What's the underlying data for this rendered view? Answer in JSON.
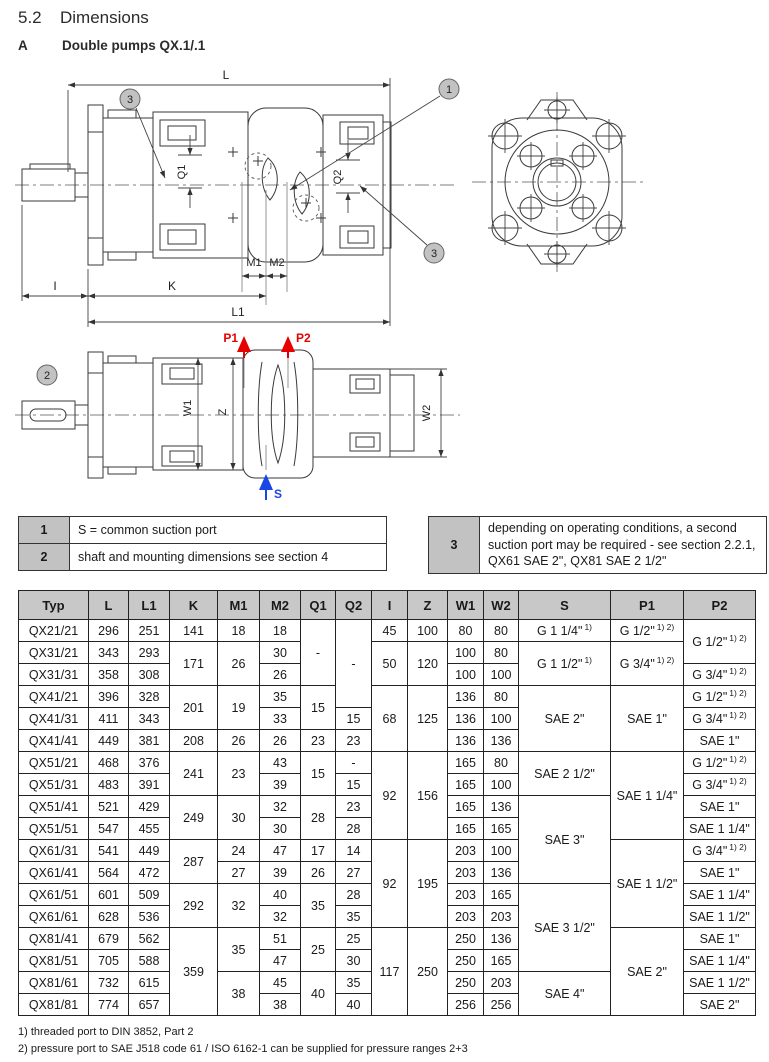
{
  "page": {
    "section": "5.2",
    "title": "Dimensions",
    "item_letter": "A",
    "subtitle": "Double pumps QX.1/.1"
  },
  "drawing": {
    "dim_labels": {
      "L": "L",
      "L1": "L1",
      "K": "K",
      "I": "I",
      "M1": "M1",
      "M2": "M2",
      "Q1": "Q1",
      "Q2": "Q2",
      "W1": "W1",
      "W2": "W2",
      "Z": "Z"
    },
    "ports": {
      "P1": "P1",
      "P2": "P2",
      "S": "S"
    },
    "callouts": {
      "c1": "1",
      "c2": "2",
      "c3": "3"
    },
    "colors": {
      "pressure_port": "#e60000",
      "suction_port": "#1a46e6",
      "line": "#3a3a3a",
      "callout_fill": "#c2c2c2",
      "table_header": "#c8c8c8"
    }
  },
  "legend": {
    "notes": [
      {
        "num": "1",
        "text": "S = common suction port"
      },
      {
        "num": "2",
        "text": "shaft and mounting dimensions see section 4"
      },
      {
        "num": "3",
        "text": "depending on operating conditions, a second suction port may be required - see section 2.2.1, QX61 SAE 2\", QX81 SAE 2 1/2\""
      }
    ]
  },
  "table": {
    "header": [
      "Typ",
      "L",
      "L1",
      "K",
      "M1",
      "M2",
      "Q1",
      "Q2",
      "I",
      "Z",
      "W1",
      "W2",
      "S",
      "P1",
      "P2"
    ],
    "rows": [
      [
        {
          "t": "QX21/21"
        },
        {
          "t": "296"
        },
        {
          "t": "251"
        },
        {
          "t": "141"
        },
        {
          "t": "18"
        },
        {
          "t": "18"
        },
        {
          "t": "-",
          "rs": 3
        },
        {
          "t": "-",
          "rs": 4
        },
        {
          "t": "45"
        },
        {
          "t": "100"
        },
        {
          "t": "80"
        },
        {
          "t": "80"
        },
        {
          "t": "G 1 1/4\"",
          "sup": "1)"
        },
        {
          "t": "G 1/2\"",
          "sup": "1) 2)"
        },
        {
          "t": "G 1/2\"",
          "sup": "1) 2)",
          "rs": 2
        }
      ],
      [
        {
          "t": "QX31/21"
        },
        {
          "t": "343"
        },
        {
          "t": "293"
        },
        {
          "t": "171",
          "rs": 2
        },
        {
          "t": "26",
          "rs": 2
        },
        {
          "t": "30"
        },
        {
          "t": "50",
          "rs": 2
        },
        {
          "t": "120",
          "rs": 2
        },
        {
          "t": "100"
        },
        {
          "t": "80"
        },
        {
          "t": "G 1 1/2\"",
          "sup": "1)",
          "rs": 2
        },
        {
          "t": "G 3/4\"",
          "sup": "1) 2)",
          "rs": 2
        }
      ],
      [
        {
          "t": "QX31/31"
        },
        {
          "t": "358"
        },
        {
          "t": "308"
        },
        {
          "t": "26"
        },
        {
          "t": "100"
        },
        {
          "t": "100"
        },
        {
          "t": "G 3/4\"",
          "sup": "1) 2)"
        }
      ],
      [
        {
          "t": "QX41/21"
        },
        {
          "t": "396"
        },
        {
          "t": "328"
        },
        {
          "t": "201",
          "rs": 2
        },
        {
          "t": "19",
          "rs": 2
        },
        {
          "t": "35"
        },
        {
          "t": "15",
          "rs": 2
        },
        {
          "t": "68",
          "rs": 3
        },
        {
          "t": "125",
          "rs": 3
        },
        {
          "t": "136"
        },
        {
          "t": "80"
        },
        {
          "t": "SAE 2\"",
          "rs": 3
        },
        {
          "t": "SAE 1\"",
          "rs": 3
        },
        {
          "t": "G 1/2\"",
          "sup": "1) 2)"
        }
      ],
      [
        {
          "t": "QX41/31"
        },
        {
          "t": "411"
        },
        {
          "t": "343"
        },
        {
          "t": "33"
        },
        {
          "t": "15"
        },
        {
          "t": "136"
        },
        {
          "t": "100"
        },
        {
          "t": "G 3/4\"",
          "sup": "1) 2)"
        }
      ],
      [
        {
          "t": "QX41/41"
        },
        {
          "t": "449"
        },
        {
          "t": "381"
        },
        {
          "t": "208"
        },
        {
          "t": "26"
        },
        {
          "t": "26"
        },
        {
          "t": "23"
        },
        {
          "t": "23"
        },
        {
          "t": "136"
        },
        {
          "t": "136"
        },
        {
          "t": "SAE 1\""
        }
      ],
      [
        {
          "t": "QX51/21"
        },
        {
          "t": "468"
        },
        {
          "t": "376"
        },
        {
          "t": "241",
          "rs": 2
        },
        {
          "t": "23",
          "rs": 2
        },
        {
          "t": "43"
        },
        {
          "t": "15",
          "rs": 2
        },
        {
          "t": "-"
        },
        {
          "t": "92",
          "rs": 4
        },
        {
          "t": "156",
          "rs": 4
        },
        {
          "t": "165"
        },
        {
          "t": "80"
        },
        {
          "t": "SAE 2 1/2\"",
          "rs": 2
        },
        {
          "t": "SAE 1 1/4\"",
          "rs": 4
        },
        {
          "t": "G 1/2\"",
          "sup": "1) 2)"
        }
      ],
      [
        {
          "t": "QX51/31"
        },
        {
          "t": "483"
        },
        {
          "t": "391"
        },
        {
          "t": "39"
        },
        {
          "t": "15"
        },
        {
          "t": "165"
        },
        {
          "t": "100"
        },
        {
          "t": "G 3/4\"",
          "sup": "1) 2)"
        }
      ],
      [
        {
          "t": "QX51/41"
        },
        {
          "t": "521"
        },
        {
          "t": "429"
        },
        {
          "t": "249",
          "rs": 2
        },
        {
          "t": "30",
          "rs": 2
        },
        {
          "t": "32"
        },
        {
          "t": "28",
          "rs": 2
        },
        {
          "t": "23"
        },
        {
          "t": "165"
        },
        {
          "t": "136"
        },
        {
          "t": "SAE 3\"",
          "rs": 4
        },
        {
          "t": "SAE 1\""
        }
      ],
      [
        {
          "t": "QX51/51"
        },
        {
          "t": "547"
        },
        {
          "t": "455"
        },
        {
          "t": "30"
        },
        {
          "t": "28"
        },
        {
          "t": "165"
        },
        {
          "t": "165"
        },
        {
          "t": "SAE 1 1/4\""
        }
      ],
      [
        {
          "t": "QX61/31"
        },
        {
          "t": "541"
        },
        {
          "t": "449"
        },
        {
          "t": "287",
          "rs": 2
        },
        {
          "t": "24"
        },
        {
          "t": "47"
        },
        {
          "t": "17"
        },
        {
          "t": "14"
        },
        {
          "t": "92",
          "rs": 4
        },
        {
          "t": "195",
          "rs": 4
        },
        {
          "t": "203"
        },
        {
          "t": "100"
        },
        {
          "t": "SAE 1 1/2\"",
          "rs": 4
        },
        {
          "t": "G 3/4\"",
          "sup": "1) 2)"
        }
      ],
      [
        {
          "t": "QX61/41"
        },
        {
          "t": "564"
        },
        {
          "t": "472"
        },
        {
          "t": "27"
        },
        {
          "t": "39"
        },
        {
          "t": "26"
        },
        {
          "t": "27"
        },
        {
          "t": "203"
        },
        {
          "t": "136"
        },
        {
          "t": "SAE 1\""
        }
      ],
      [
        {
          "t": "QX61/51"
        },
        {
          "t": "601"
        },
        {
          "t": "509"
        },
        {
          "t": "292",
          "rs": 2
        },
        {
          "t": "32",
          "rs": 2
        },
        {
          "t": "40"
        },
        {
          "t": "35",
          "rs": 2
        },
        {
          "t": "28"
        },
        {
          "t": "203"
        },
        {
          "t": "165"
        },
        {
          "t": "SAE 3 1/2\"",
          "rs": 4
        },
        {
          "t": "SAE 1 1/4\""
        }
      ],
      [
        {
          "t": "QX61/61"
        },
        {
          "t": "628"
        },
        {
          "t": "536"
        },
        {
          "t": "32"
        },
        {
          "t": "35"
        },
        {
          "t": "203"
        },
        {
          "t": "203"
        },
        {
          "t": "SAE 1 1/2\""
        }
      ],
      [
        {
          "t": "QX81/41"
        },
        {
          "t": "679"
        },
        {
          "t": "562"
        },
        {
          "t": "359",
          "rs": 4
        },
        {
          "t": "35",
          "rs": 2
        },
        {
          "t": "51"
        },
        {
          "t": "25",
          "rs": 2
        },
        {
          "t": "25"
        },
        {
          "t": "117",
          "rs": 4
        },
        {
          "t": "250",
          "rs": 4
        },
        {
          "t": "250"
        },
        {
          "t": "136"
        },
        {
          "t": "SAE 2\"",
          "rs": 4
        },
        {
          "t": "SAE 1\""
        }
      ],
      [
        {
          "t": "QX81/51"
        },
        {
          "t": "705"
        },
        {
          "t": "588"
        },
        {
          "t": "47"
        },
        {
          "t": "30"
        },
        {
          "t": "250"
        },
        {
          "t": "165"
        },
        {
          "t": "SAE 1 1/4\""
        }
      ],
      [
        {
          "t": "QX81/61"
        },
        {
          "t": "732"
        },
        {
          "t": "615"
        },
        {
          "t": "38",
          "rs": 2
        },
        {
          "t": "45"
        },
        {
          "t": "40",
          "rs": 2
        },
        {
          "t": "35"
        },
        {
          "t": "250"
        },
        {
          "t": "203"
        },
        {
          "t": "SAE 4\"",
          "rs": 2
        },
        {
          "t": "SAE 1 1/2\""
        }
      ],
      [
        {
          "t": "QX81/81"
        },
        {
          "t": "774"
        },
        {
          "t": "657"
        },
        {
          "t": "38"
        },
        {
          "t": "40"
        },
        {
          "t": "256"
        },
        {
          "t": "256"
        },
        {
          "t": "SAE 2\""
        }
      ]
    ]
  },
  "footnotes": [
    "1) threaded port to DIN 3852, Part 2",
    "2) pressure port to SAE J518 code 61 / ISO 6162-1 can be supplied for pressure ranges 2+3"
  ]
}
